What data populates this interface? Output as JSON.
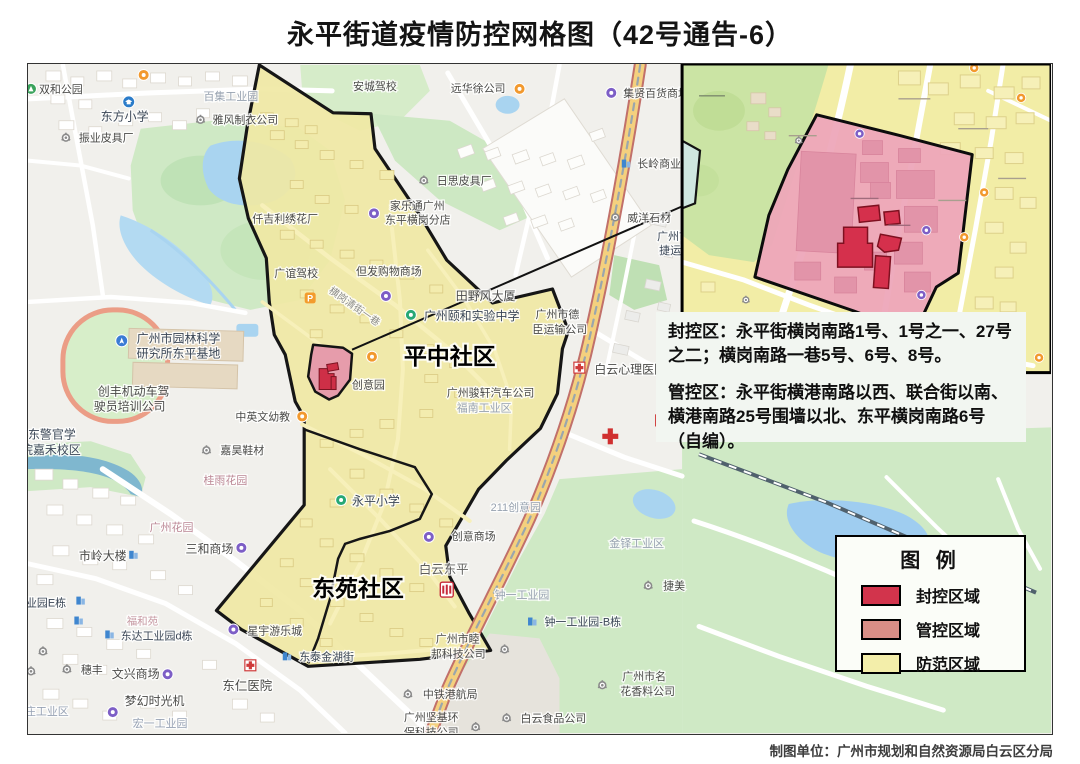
{
  "title": "永平街道疫情防控网格图（42号通告-6）",
  "info_panel": {
    "sealed_line": "封控区：永平街横岗南路1号、1号之一、27号之二；横岗南路一巷5号、6号、8号。",
    "managed_line": "管控区：永平街横港南路以西、联合街以南、横港南路25号围墙以北、东平横岗南路6号（自编）。"
  },
  "legend": {
    "title": "图 例",
    "items": [
      {
        "label": "封控区域",
        "color": "#d2344c"
      },
      {
        "label": "管控区域",
        "color": "#d98e86"
      },
      {
        "label": "防范区域",
        "color": "#f3eeaa"
      }
    ]
  },
  "attribution": "制图单位：广州市规划和自然资源局白云区分局",
  "colors": {
    "sealed_zone": "#d5304c",
    "managed_zone_main": "#e69cab",
    "managed_zone_inset": "#eda7b9",
    "prevention_zone": "#f0e8a4",
    "water": "#a9d4f0",
    "park_green": "#cfe9c5",
    "zone_outline": "#161616"
  },
  "district_names": [
    "平中社区",
    "东苑社区"
  ],
  "map_labels": [
    {
      "t": "双和公园",
      "x": 38,
      "y": 92
    },
    {
      "t": "东方小学",
      "x": 100,
      "y": 120,
      "s": 12,
      "c": "#3a4656"
    },
    {
      "t": "振业皮具厂",
      "x": 78,
      "y": 141
    },
    {
      "t": "百集工业园",
      "x": 203,
      "y": 99,
      "c": "#97a2b0"
    },
    {
      "t": "雅风制衣公司",
      "x": 212,
      "y": 123
    },
    {
      "t": "安城驾校",
      "x": 353,
      "y": 89
    },
    {
      "t": "远华徐公司",
      "x": 451,
      "y": 91
    },
    {
      "t": "集贤百货商场",
      "x": 624,
      "y": 96
    },
    {
      "t": "长岭商业",
      "x": 638,
      "y": 167
    },
    {
      "t": "日思皮具厂",
      "x": 437,
      "y": 184
    },
    {
      "t": "威洋石材",
      "x": 628,
      "y": 221
    },
    {
      "t": "广州市",
      "x": 658,
      "y": 240,
      "c": "#3a4656"
    },
    {
      "t": "捷运输",
      "x": 660,
      "y": 254,
      "c": "#3a4656"
    },
    {
      "t": "仟吉利绣花厂",
      "x": 252,
      "y": 222
    },
    {
      "t": "家乐通广州",
      "x": 390,
      "y": 209
    },
    {
      "t": "东平横岗分店",
      "x": 385,
      "y": 223
    },
    {
      "t": "广谊驾校",
      "x": 274,
      "y": 277
    },
    {
      "t": "但发购物商场",
      "x": 356,
      "y": 275
    },
    {
      "t": "横岗清街一巷",
      "x": 328,
      "y": 292,
      "s": 10,
      "c": "#8d8d8a",
      "r": 35
    },
    {
      "t": "田野风大厦",
      "x": 456,
      "y": 300,
      "s": 12
    },
    {
      "t": "广州颐和实验中学",
      "x": 424,
      "y": 320,
      "s": 12,
      "c": "#3a4656"
    },
    {
      "t": "广州市德",
      "x": 536,
      "y": 318
    },
    {
      "t": "臣运输公司",
      "x": 533,
      "y": 333
    },
    {
      "t": "平中社区",
      "x": 404,
      "y": 365,
      "s": 23,
      "c": "#000000",
      "b": 1
    },
    {
      "t": "广州骏轩汽车公司",
      "x": 447,
      "y": 397
    },
    {
      "t": "福南工业区",
      "x": 457,
      "y": 412,
      "c": "#97a2b0"
    },
    {
      "t": "创意园",
      "x": 352,
      "y": 389
    },
    {
      "t": "广州市园林科学",
      "x": 136,
      "y": 343,
      "s": 12,
      "c": "#3a4656"
    },
    {
      "t": "研究所东平基地",
      "x": 136,
      "y": 358,
      "s": 12,
      "c": "#3a4656"
    },
    {
      "t": "创丰机动车驾",
      "x": 97,
      "y": 396,
      "s": 12
    },
    {
      "t": "驶员培训公司",
      "x": 93,
      "y": 411,
      "s": 12
    },
    {
      "t": "广东警官学",
      "x": 15,
      "y": 439,
      "s": 12,
      "c": "#3a4656"
    },
    {
      "t": "院嘉禾校区",
      "x": 20,
      "y": 455,
      "s": 12,
      "c": "#3a4656"
    },
    {
      "t": "中英文幼教",
      "x": 235,
      "y": 421
    },
    {
      "t": "嘉昊鞋材",
      "x": 220,
      "y": 455
    },
    {
      "t": "桂雨花园",
      "x": 203,
      "y": 485,
      "c": "#bb8694"
    },
    {
      "t": "广州花园",
      "x": 149,
      "y": 532,
      "c": "#bb8694"
    },
    {
      "t": "三和商场",
      "x": 185,
      "y": 554,
      "s": 12
    },
    {
      "t": "市岭大楼",
      "x": 78,
      "y": 561,
      "s": 12
    },
    {
      "t": "永平小学",
      "x": 352,
      "y": 506,
      "s": 12,
      "c": "#3a4656"
    },
    {
      "t": "白云东平",
      "x": 419,
      "y": 575,
      "s": 12.5,
      "c": "#5f5f5d"
    },
    {
      "t": "东苑社区",
      "x": 312,
      "y": 598,
      "s": 23,
      "c": "#000000",
      "b": 1
    },
    {
      "t": "211创意园",
      "x": 491,
      "y": 512,
      "c": "#97a2b0"
    },
    {
      "t": "创意商场",
      "x": 452,
      "y": 541
    },
    {
      "t": "金铎工业区",
      "x": 610,
      "y": 548,
      "c": "#97a2b0"
    },
    {
      "t": "钟一工业园",
      "x": 495,
      "y": 600,
      "c": "#97a2b0"
    },
    {
      "t": "捷美",
      "x": 664,
      "y": 591
    },
    {
      "t": "钟一工业园-B栋",
      "x": 545,
      "y": 627,
      "c": "#3a4656"
    },
    {
      "t": "广州市睦",
      "x": 436,
      "y": 644
    },
    {
      "t": "邦科技公司",
      "x": 431,
      "y": 659
    },
    {
      "t": "中铁港航局",
      "x": 423,
      "y": 700
    },
    {
      "t": "广州坚基环",
      "x": 404,
      "y": 723
    },
    {
      "t": "保科技公司",
      "x": 404,
      "y": 738
    },
    {
      "t": "白云食品公司",
      "x": 521,
      "y": 724
    },
    {
      "t": "广州市名",
      "x": 623,
      "y": 682
    },
    {
      "t": "花香料公司",
      "x": 621,
      "y": 697
    },
    {
      "t": "东仁医院",
      "x": 222,
      "y": 692,
      "s": 12.5
    },
    {
      "t": "星宇游乐城",
      "x": 247,
      "y": 636
    },
    {
      "t": "东泰金湖街",
      "x": 299,
      "y": 662,
      "c": "#3a4656"
    },
    {
      "t": "文兴商场",
      "x": 111,
      "y": 680,
      "s": 12
    },
    {
      "t": "梦幻时光机",
      "x": 124,
      "y": 707,
      "s": 12
    },
    {
      "t": "穗丰",
      "x": 80,
      "y": 675
    },
    {
      "t": "宏一工业园",
      "x": 132,
      "y": 729,
      "c": "#97a2b4"
    },
    {
      "t": "雁庄工业区",
      "x": 13,
      "y": 717,
      "c": "#97a2b4"
    },
    {
      "t": "工业园E栋",
      "x": 14,
      "y": 608,
      "c": "#3a4656"
    },
    {
      "t": "东达工业园d栋",
      "x": 120,
      "y": 641,
      "c": "#3a4656"
    },
    {
      "t": "福和苑",
      "x": 126,
      "y": 626,
      "s": 10.5,
      "c": "#c79aa4"
    },
    {
      "t": "白云心理医院",
      "x": 595,
      "y": 374,
      "s": 12
    }
  ],
  "map_icons": [
    {
      "k": "park",
      "x": 30,
      "y": 88
    },
    {
      "k": "school",
      "x": 128,
      "y": 101
    },
    {
      "k": "orange",
      "x": 143,
      "y": 74
    },
    {
      "k": "gear",
      "x": 65,
      "y": 137
    },
    {
      "k": "gear",
      "x": 200,
      "y": 119
    },
    {
      "k": "orange",
      "x": 520,
      "y": 88
    },
    {
      "k": "purple",
      "x": 612,
      "y": 92
    },
    {
      "k": "building",
      "x": 627,
      "y": 163
    },
    {
      "k": "gear",
      "x": 424,
      "y": 180
    },
    {
      "k": "gear",
      "x": 616,
      "y": 217
    },
    {
      "k": "purple",
      "x": 374,
      "y": 213
    },
    {
      "k": "purple",
      "x": 386,
      "y": 296
    },
    {
      "k": "parking",
      "x": 310,
      "y": 298
    },
    {
      "k": "green",
      "x": 411,
      "y": 315
    },
    {
      "k": "orange",
      "x": 372,
      "y": 357
    },
    {
      "k": "orange",
      "x": 302,
      "y": 417
    },
    {
      "k": "nav",
      "x": 121,
      "y": 341
    },
    {
      "k": "gear",
      "x": 206,
      "y": 451
    },
    {
      "k": "purple",
      "x": 241,
      "y": 549
    },
    {
      "k": "building",
      "x": 133,
      "y": 556
    },
    {
      "k": "green",
      "x": 341,
      "y": 501
    },
    {
      "k": "metro",
      "x": 447,
      "y": 591
    },
    {
      "k": "purple",
      "x": 429,
      "y": 538
    },
    {
      "k": "gear",
      "x": 649,
      "y": 587
    },
    {
      "k": "building",
      "x": 533,
      "y": 623
    },
    {
      "k": "gear",
      "x": 505,
      "y": 651
    },
    {
      "k": "gear",
      "x": 408,
      "y": 696
    },
    {
      "k": "gear",
      "x": 476,
      "y": 729
    },
    {
      "k": "gear",
      "x": 507,
      "y": 720
    },
    {
      "k": "gear",
      "x": 603,
      "y": 687
    },
    {
      "k": "hospital",
      "x": 250,
      "y": 667
    },
    {
      "k": "purple",
      "x": 233,
      "y": 631
    },
    {
      "k": "building",
      "x": 287,
      "y": 658
    },
    {
      "k": "purple",
      "x": 167,
      "y": 676
    },
    {
      "k": "purple",
      "x": 112,
      "y": 714
    },
    {
      "k": "gear",
      "x": 66,
      "y": 671
    },
    {
      "k": "gear",
      "x": 42,
      "y": 653
    },
    {
      "k": "gear",
      "x": 30,
      "y": 673
    },
    {
      "k": "building",
      "x": 80,
      "y": 602
    },
    {
      "k": "building",
      "x": 78,
      "y": 622
    },
    {
      "k": "building",
      "x": 109,
      "y": 636
    },
    {
      "k": "hospital",
      "x": 580,
      "y": 368
    },
    {
      "k": "hospital",
      "x": 662,
      "y": 421
    },
    {
      "k": "redcross",
      "x": 611,
      "y": 437
    }
  ],
  "inset_icons": [
    {
      "k": "orange",
      "x": 976,
      "y": 67
    },
    {
      "k": "orange",
      "x": 1023,
      "y": 97
    },
    {
      "k": "orange",
      "x": 986,
      "y": 192
    },
    {
      "k": "orange",
      "x": 966,
      "y": 237
    },
    {
      "k": "purple",
      "x": 928,
      "y": 230
    },
    {
      "k": "purple",
      "x": 923,
      "y": 295
    },
    {
      "k": "purple",
      "x": 861,
      "y": 133
    },
    {
      "k": "orange",
      "x": 1041,
      "y": 358
    },
    {
      "k": "gear",
      "x": 747,
      "y": 300
    },
    {
      "k": "gear",
      "x": 800,
      "y": 140
    }
  ]
}
